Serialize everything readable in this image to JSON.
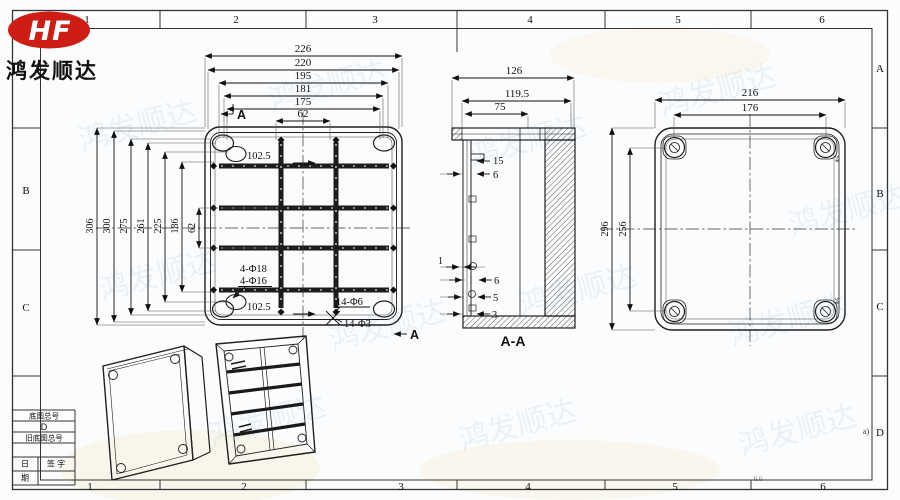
{
  "logo": {
    "monogram": "HF",
    "company": "鸿发顺达"
  },
  "watermark": {
    "text": "鸿发顺达"
  },
  "border": {
    "top_cols": [
      "1",
      "2",
      "3",
      "4",
      "5",
      "6"
    ],
    "bottom_cols": [
      "1",
      "2",
      "3",
      "4",
      "5",
      "6"
    ],
    "right_rows": [
      "A",
      "B",
      "C",
      "D"
    ],
    "left_rows": [
      "B",
      "C"
    ],
    "page_note": "a)",
    "stray_note": "6.6"
  },
  "title_block": {
    "base_no_label": "底图总号",
    "drawing_letter": "D",
    "old_base_no_label": "旧底图总号",
    "date_top": "日",
    "date_bottom": "期",
    "sign_label": "签 字"
  },
  "front_view": {
    "top_dims": [
      "226",
      "220",
      "195",
      "181",
      "175",
      "62"
    ],
    "side_dims": [
      "306",
      "300",
      "275",
      "261",
      "225",
      "186",
      "62"
    ],
    "offset_top": "102.5",
    "offset_bottom": "102.5",
    "holes_large": "4-Φ18",
    "holes_large2": "4-Φ16",
    "holes_small": "14-Φ6",
    "holes_small2": "14-Φ3",
    "section_marker": "A"
  },
  "section_view": {
    "top_dims": [
      "126",
      "119.5",
      "75"
    ],
    "rib_dim": "15",
    "wall_dim_top": "6",
    "gap_dim": "1",
    "wall_dim": "6",
    "boss_dim": "5",
    "base_dim": "3",
    "label": "A-A"
  },
  "back_view": {
    "top_dims": [
      "216",
      "176"
    ],
    "side_dims": [
      "296",
      "256"
    ],
    "corner_note": "Φ5"
  }
}
